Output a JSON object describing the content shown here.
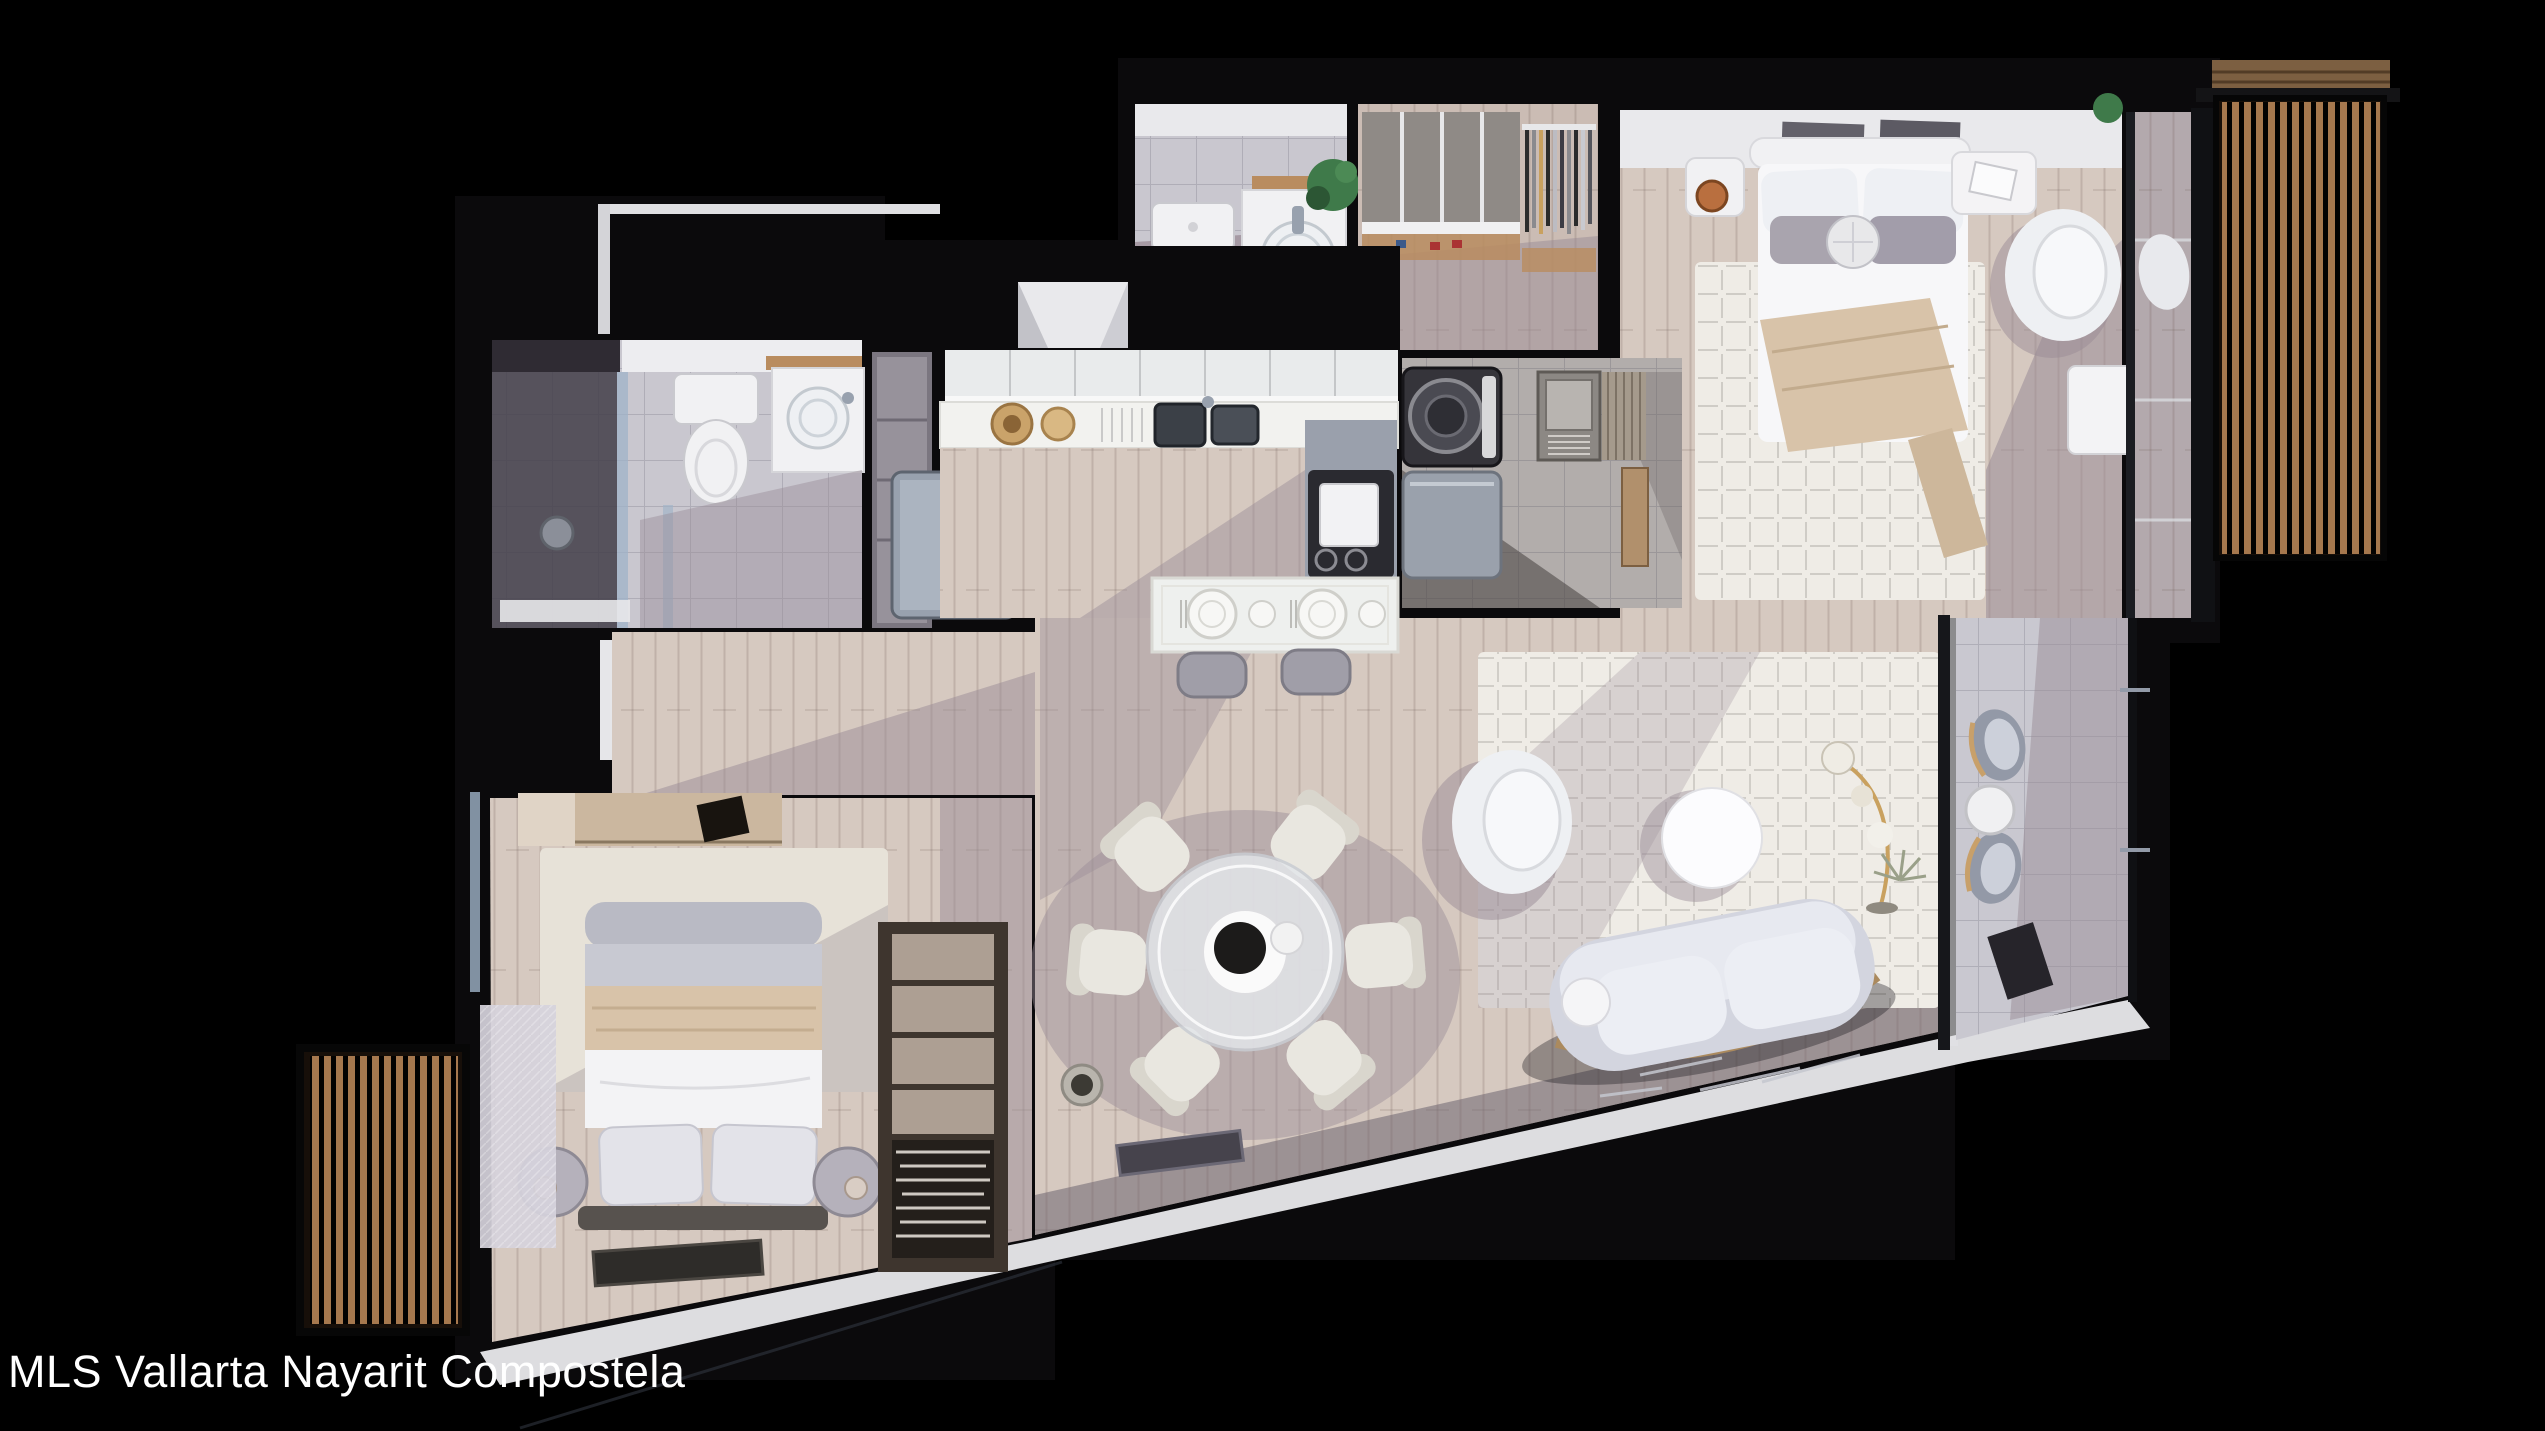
{
  "watermark": {
    "text": "MLS Vallarta Nayarit Compostela"
  },
  "colors": {
    "background": "#000000",
    "watermark_text": "#ffffff",
    "wall": "#0b0a0c",
    "wood_floor": "#d6c9c0",
    "wood_floor_deep": "#cbbcb4",
    "floor_shadow": "#998b96",
    "white_surface": "#f1f1f3",
    "white_wall": "#e9e9ec",
    "tile_light": "#c9c7cf",
    "tile_dark": "#56525c",
    "slat_wood": "#a6784e",
    "slat_base": "#170f09",
    "rug": "#efece6",
    "rug_bedroom": "#e7e2d8",
    "sofa": "#d3d5df",
    "cushion": "#eceef4",
    "blanket": "#d8c3a9",
    "bench_dark": "#57524e",
    "wardrobe_dark": "#3e352e",
    "box_beige": "#ad9f93",
    "steel": "#98a1ae",
    "appliance_dark": "#35343a",
    "copper": "#b96f3f",
    "plant_green": "#3f7a4a",
    "glass": "#9fb3c8",
    "counter_wood": "#b98c5f",
    "stone": "#c9c8d0",
    "exterior_band": "#dddde0"
  }
}
